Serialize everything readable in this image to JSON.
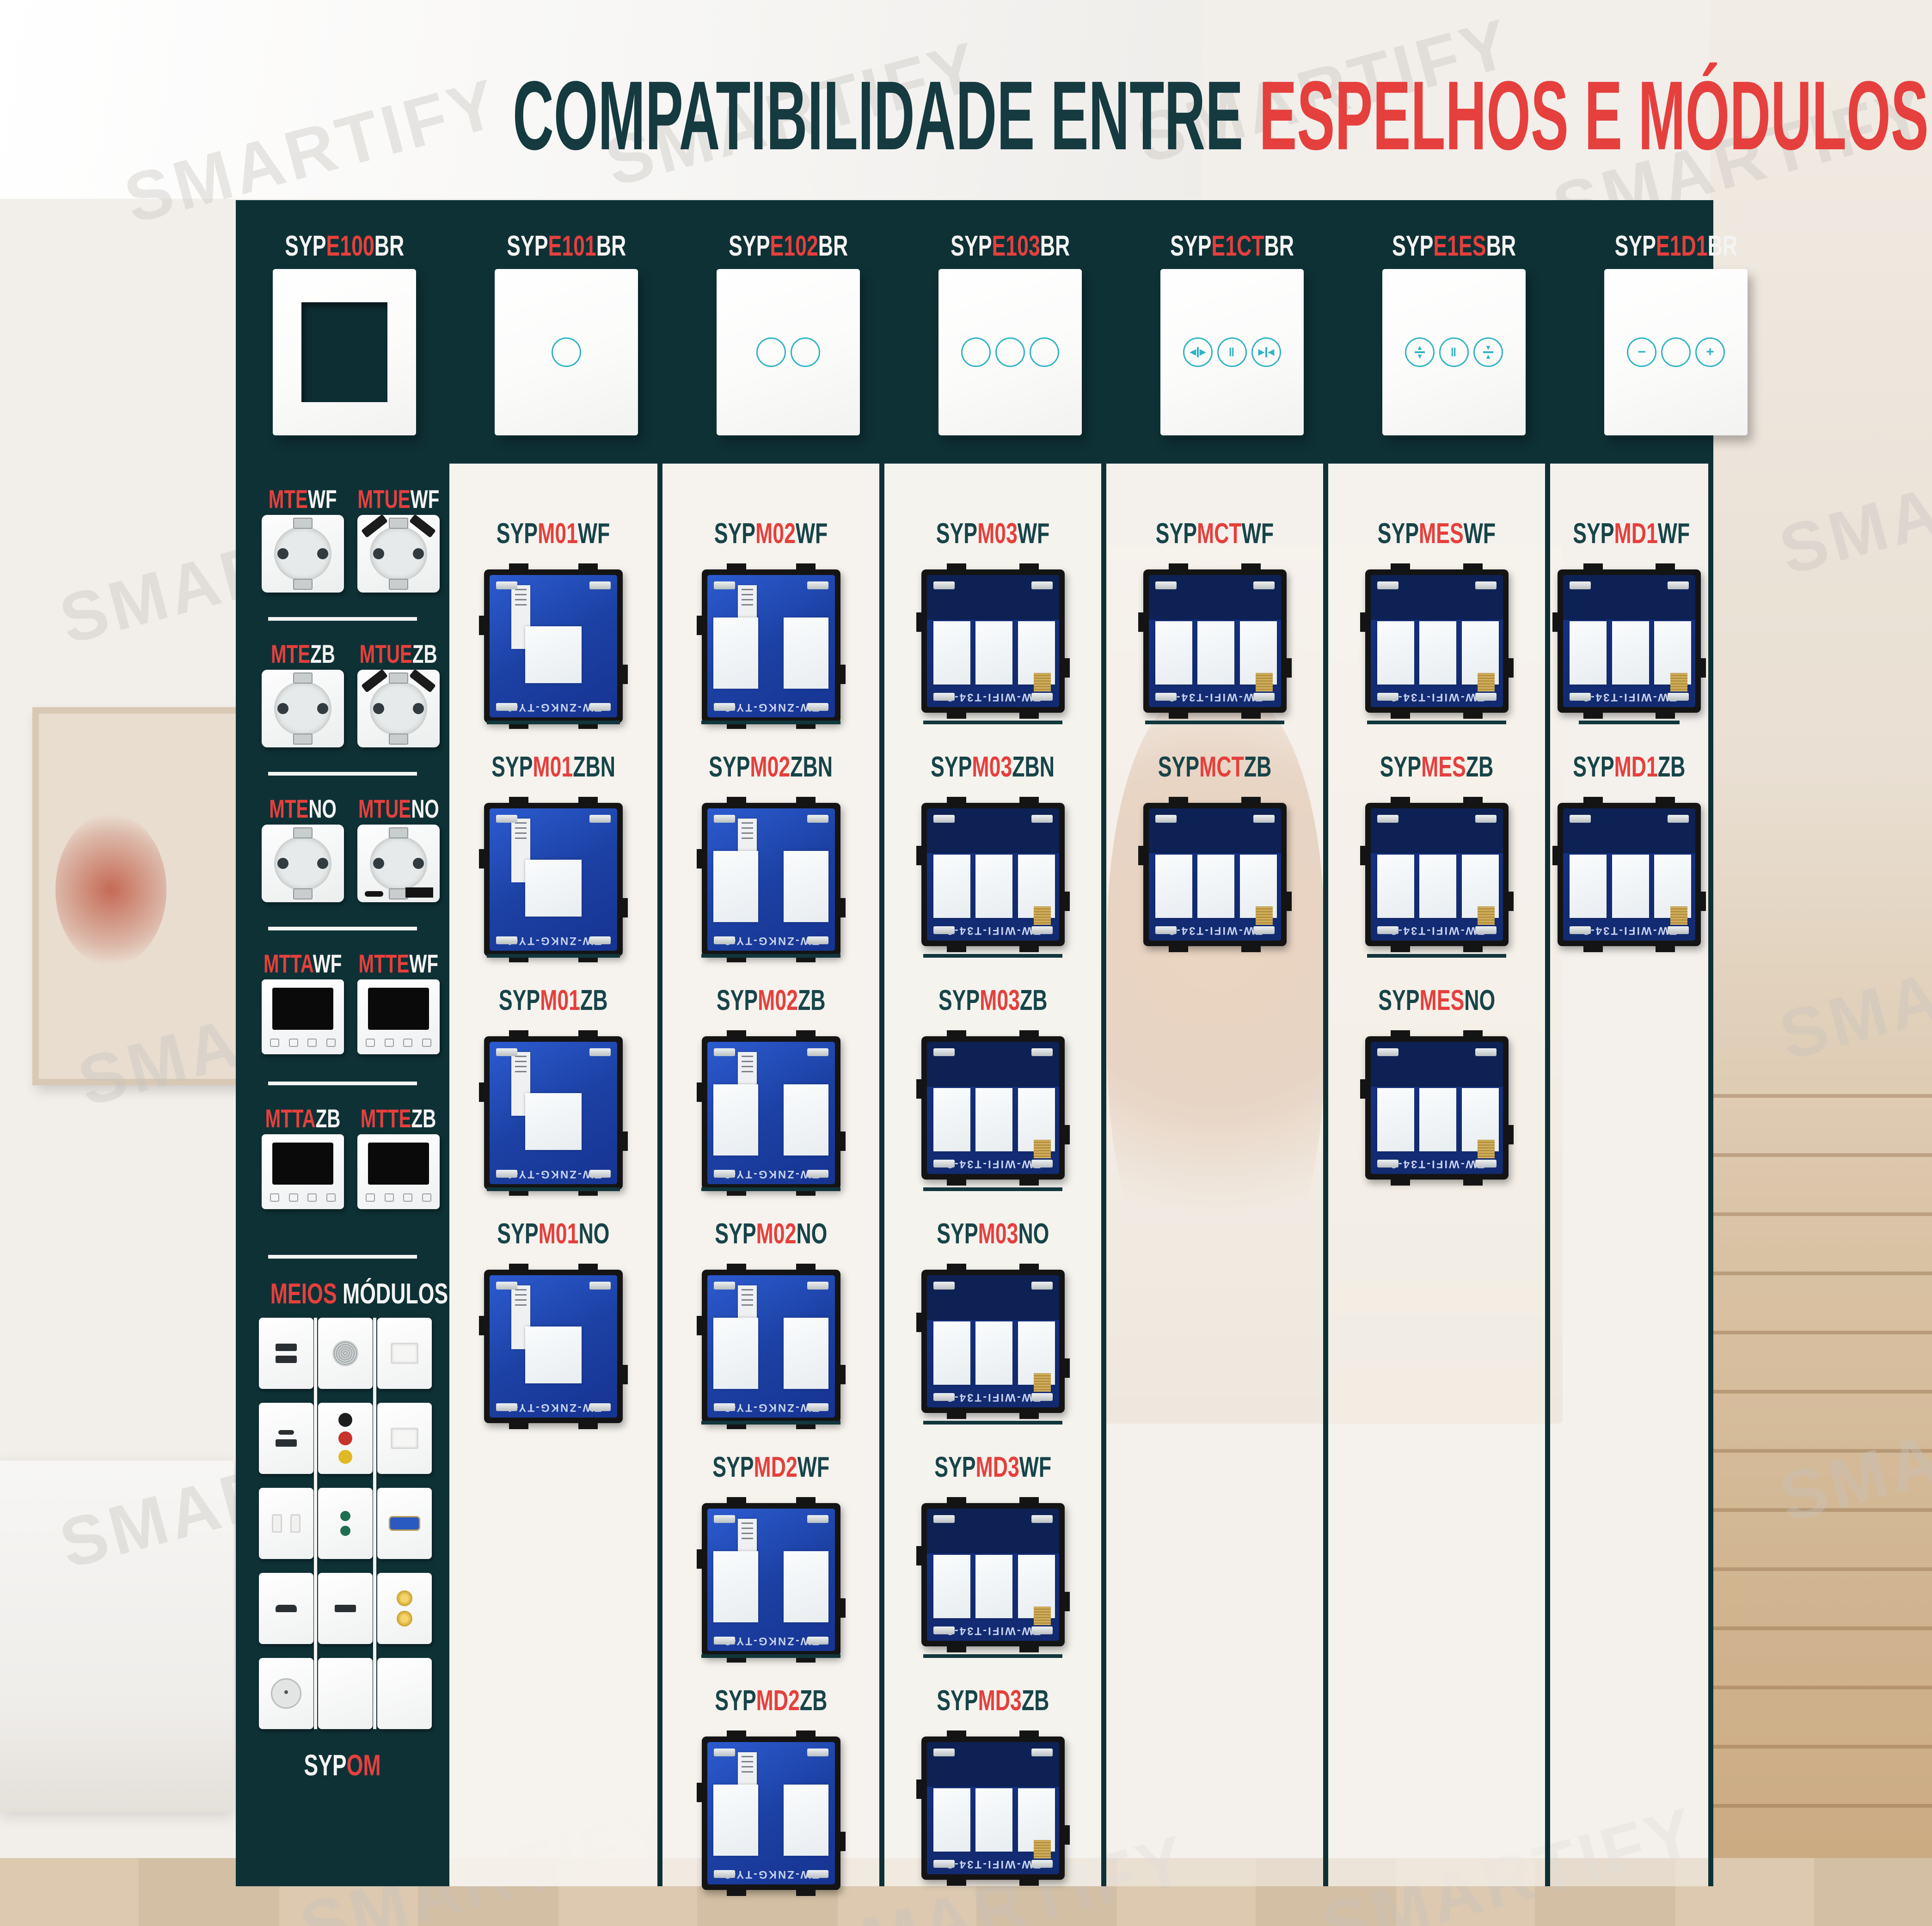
{
  "title": {
    "dark": "COMPATIBILIDADE ENTRE",
    "red": "ESPELHOS E MÓDULOS"
  },
  "colors": {
    "teal_dark": "#0e3136",
    "title_teal": "#153a40",
    "red": "#e5403d",
    "touch_ring_teal": "#2fb3c6",
    "pcb_blue": "#1c41a4",
    "pcb_navy": "#122a6f"
  },
  "mirrors": [
    {
      "pre": "SYP",
      "mid": "E100",
      "suf": "BR",
      "type": "frame",
      "buttons": []
    },
    {
      "pre": "SYP",
      "mid": "E101",
      "suf": "BR",
      "type": "buttons",
      "buttons": [
        "blank"
      ]
    },
    {
      "pre": "SYP",
      "mid": "E102",
      "suf": "BR",
      "type": "buttons",
      "buttons": [
        "blank",
        "blank"
      ]
    },
    {
      "pre": "SYP",
      "mid": "E103",
      "suf": "BR",
      "type": "buttons",
      "buttons": [
        "blank",
        "blank",
        "blank"
      ]
    },
    {
      "pre": "SYP",
      "mid": "E1CT",
      "suf": "BR",
      "type": "buttons",
      "buttons": [
        "curtain-open",
        "pause",
        "curtain-close"
      ]
    },
    {
      "pre": "SYP",
      "mid": "E1ES",
      "suf": "BR",
      "type": "buttons",
      "buttons": [
        "shutter-up",
        "pause",
        "shutter-down"
      ]
    },
    {
      "pre": "SYP",
      "mid": "E1D1",
      "suf": "BR",
      "type": "buttons",
      "buttons": [
        "dim-minus",
        "blank",
        "dim-plus"
      ]
    }
  ],
  "sidebar": {
    "sections": [
      {
        "items": [
          {
            "red": "MTE",
            "white": "WF",
            "image": "socket"
          },
          {
            "red": "MTUE",
            "white": "WF",
            "image": "socket-usb"
          }
        ]
      },
      {
        "items": [
          {
            "red": "MTE",
            "white": "ZB",
            "image": "socket"
          },
          {
            "red": "MTUE",
            "white": "ZB",
            "image": "socket-usb"
          }
        ]
      },
      {
        "items": [
          {
            "red": "MTE",
            "white": "NO",
            "image": "socket"
          },
          {
            "red": "MTUE",
            "white": "NO",
            "image": "socket-usb2"
          }
        ]
      },
      {
        "items": [
          {
            "red": "MTTA",
            "white": "WF",
            "image": "thermostat"
          },
          {
            "red": "MTTE",
            "white": "WF",
            "image": "thermostat"
          }
        ]
      },
      {
        "items": [
          {
            "red": "MTTA",
            "white": "ZB",
            "image": "thermostat"
          },
          {
            "red": "MTTE",
            "white": "ZB",
            "image": "thermostat"
          }
        ]
      }
    ],
    "meios": {
      "red": "MEIOS",
      "white": "MÓDULOS",
      "tiles": [
        "usb-double",
        "speaker-grille",
        "keystone-blank",
        "usb-c-and-a",
        "rca-trio",
        "keystone-blank-2",
        "socket-2pin",
        "audio-jack-pair",
        "vga",
        "hdmi",
        "usb-single",
        "f-connector-pair",
        "coax",
        "switch-blank",
        "blank"
      ]
    },
    "bottom_label": {
      "white": "SYP",
      "red": "OM"
    }
  },
  "modules": {
    "syp": "SYP",
    "pcb_text": {
      "g1": "TW-ZNKG-TY-1",
      "g2": "TW-ZNKG-TY-2",
      "g3": "TW-WIFI-T34-3"
    },
    "columns": [
      {
        "rows": [
          {
            "mid": "M01",
            "suf": "WF",
            "gang": 1
          },
          {
            "mid": "M01",
            "suf": "ZBN",
            "gang": 1
          },
          {
            "mid": "M01",
            "suf": "ZB",
            "gang": 1
          },
          {
            "mid": "M01",
            "suf": "NO",
            "gang": 1
          }
        ]
      },
      {
        "rows": [
          {
            "mid": "M02",
            "suf": "WF",
            "gang": 2
          },
          {
            "mid": "M02",
            "suf": "ZBN",
            "gang": 2
          },
          {
            "mid": "M02",
            "suf": "ZB",
            "gang": 2
          },
          {
            "mid": "M02",
            "suf": "NO",
            "gang": 2
          },
          {
            "mid": "MD2",
            "suf": "WF",
            "gang": 2
          },
          {
            "mid": "MD2",
            "suf": "ZB",
            "gang": 2
          }
        ]
      },
      {
        "rows": [
          {
            "mid": "M03",
            "suf": "WF",
            "gang": 3
          },
          {
            "mid": "M03",
            "suf": "ZBN",
            "gang": 3
          },
          {
            "mid": "M03",
            "suf": "ZB",
            "gang": 3
          },
          {
            "mid": "M03",
            "suf": "NO",
            "gang": 3
          },
          {
            "mid": "MD3",
            "suf": "WF",
            "gang": 3
          },
          {
            "mid": "MD3",
            "suf": "ZB",
            "gang": 3
          }
        ]
      },
      {
        "rows": [
          {
            "mid": "MCT",
            "suf": "WF",
            "gang": 3
          },
          {
            "mid": "MCT",
            "suf": "ZB",
            "gang": 3
          }
        ]
      },
      {
        "rows": [
          {
            "mid": "MES",
            "suf": "WF",
            "gang": 3
          },
          {
            "mid": "MES",
            "suf": "ZB",
            "gang": 3
          },
          {
            "mid": "MES",
            "suf": "NO",
            "gang": 3
          }
        ]
      },
      {
        "rows": [
          {
            "mid": "MD1",
            "suf": "WF",
            "gang": 3
          },
          {
            "mid": "MD1",
            "suf": "ZB",
            "gang": 3
          }
        ]
      }
    ]
  },
  "background": {
    "watermark": "SMARTIFY"
  }
}
